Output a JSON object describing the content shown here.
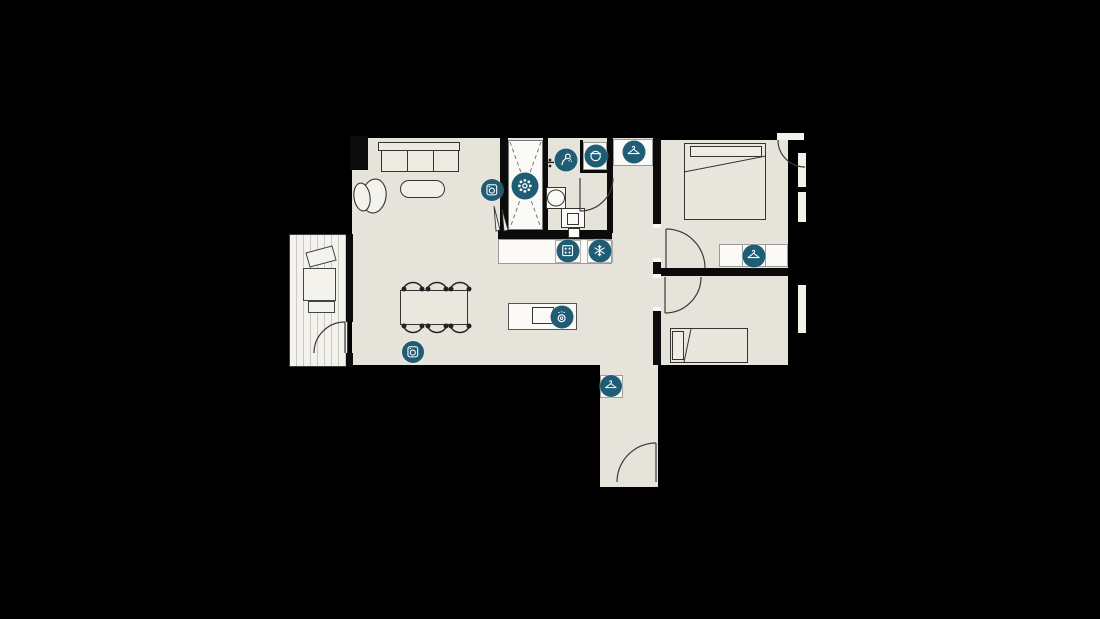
{
  "plan": {
    "kind": "apartment-floor-plan",
    "background": "#000000"
  },
  "colors": {
    "background": "#000000",
    "floor_beige": "#e6e3da",
    "balcony_floor": "#f3f2ed",
    "furniture_white": "#fbfaf7",
    "wall_black": "#0b0b0b",
    "outline_dark": "#343434",
    "accent_teal": "#1f5d75",
    "icon_glyph_white": "#ffffff"
  },
  "icons": [
    {
      "name": "washing-machine-icon",
      "type": "washer",
      "x": 492,
      "y": 190,
      "size": 22
    },
    {
      "name": "rain-shower-icon",
      "type": "flower",
      "x": 525,
      "y": 186,
      "size": 27
    },
    {
      "name": "hand-shower-icon",
      "type": "hand-shower",
      "x": 566,
      "y": 160,
      "size": 23
    },
    {
      "name": "washbasin-icon",
      "type": "basin",
      "x": 596,
      "y": 156,
      "size": 23
    },
    {
      "name": "wardrobe-hanger-icon",
      "type": "hanger",
      "x": 634,
      "y": 152,
      "size": 23
    },
    {
      "name": "cooktop-icon",
      "type": "cooktop",
      "x": 568,
      "y": 251,
      "size": 23
    },
    {
      "name": "freezer-icon",
      "type": "snowflake",
      "x": 600,
      "y": 251,
      "size": 23
    },
    {
      "name": "dishwasher-icon",
      "type": "dishwasher",
      "x": 562,
      "y": 317,
      "size": 23
    },
    {
      "name": "wardrobe-hanger-icon",
      "type": "hanger",
      "x": 754,
      "y": 256,
      "size": 23
    },
    {
      "name": "washing-machine-icon",
      "type": "washer",
      "x": 413,
      "y": 352,
      "size": 22
    },
    {
      "name": "wardrobe-hanger-icon",
      "type": "hanger",
      "x": 611,
      "y": 386,
      "size": 22
    }
  ]
}
